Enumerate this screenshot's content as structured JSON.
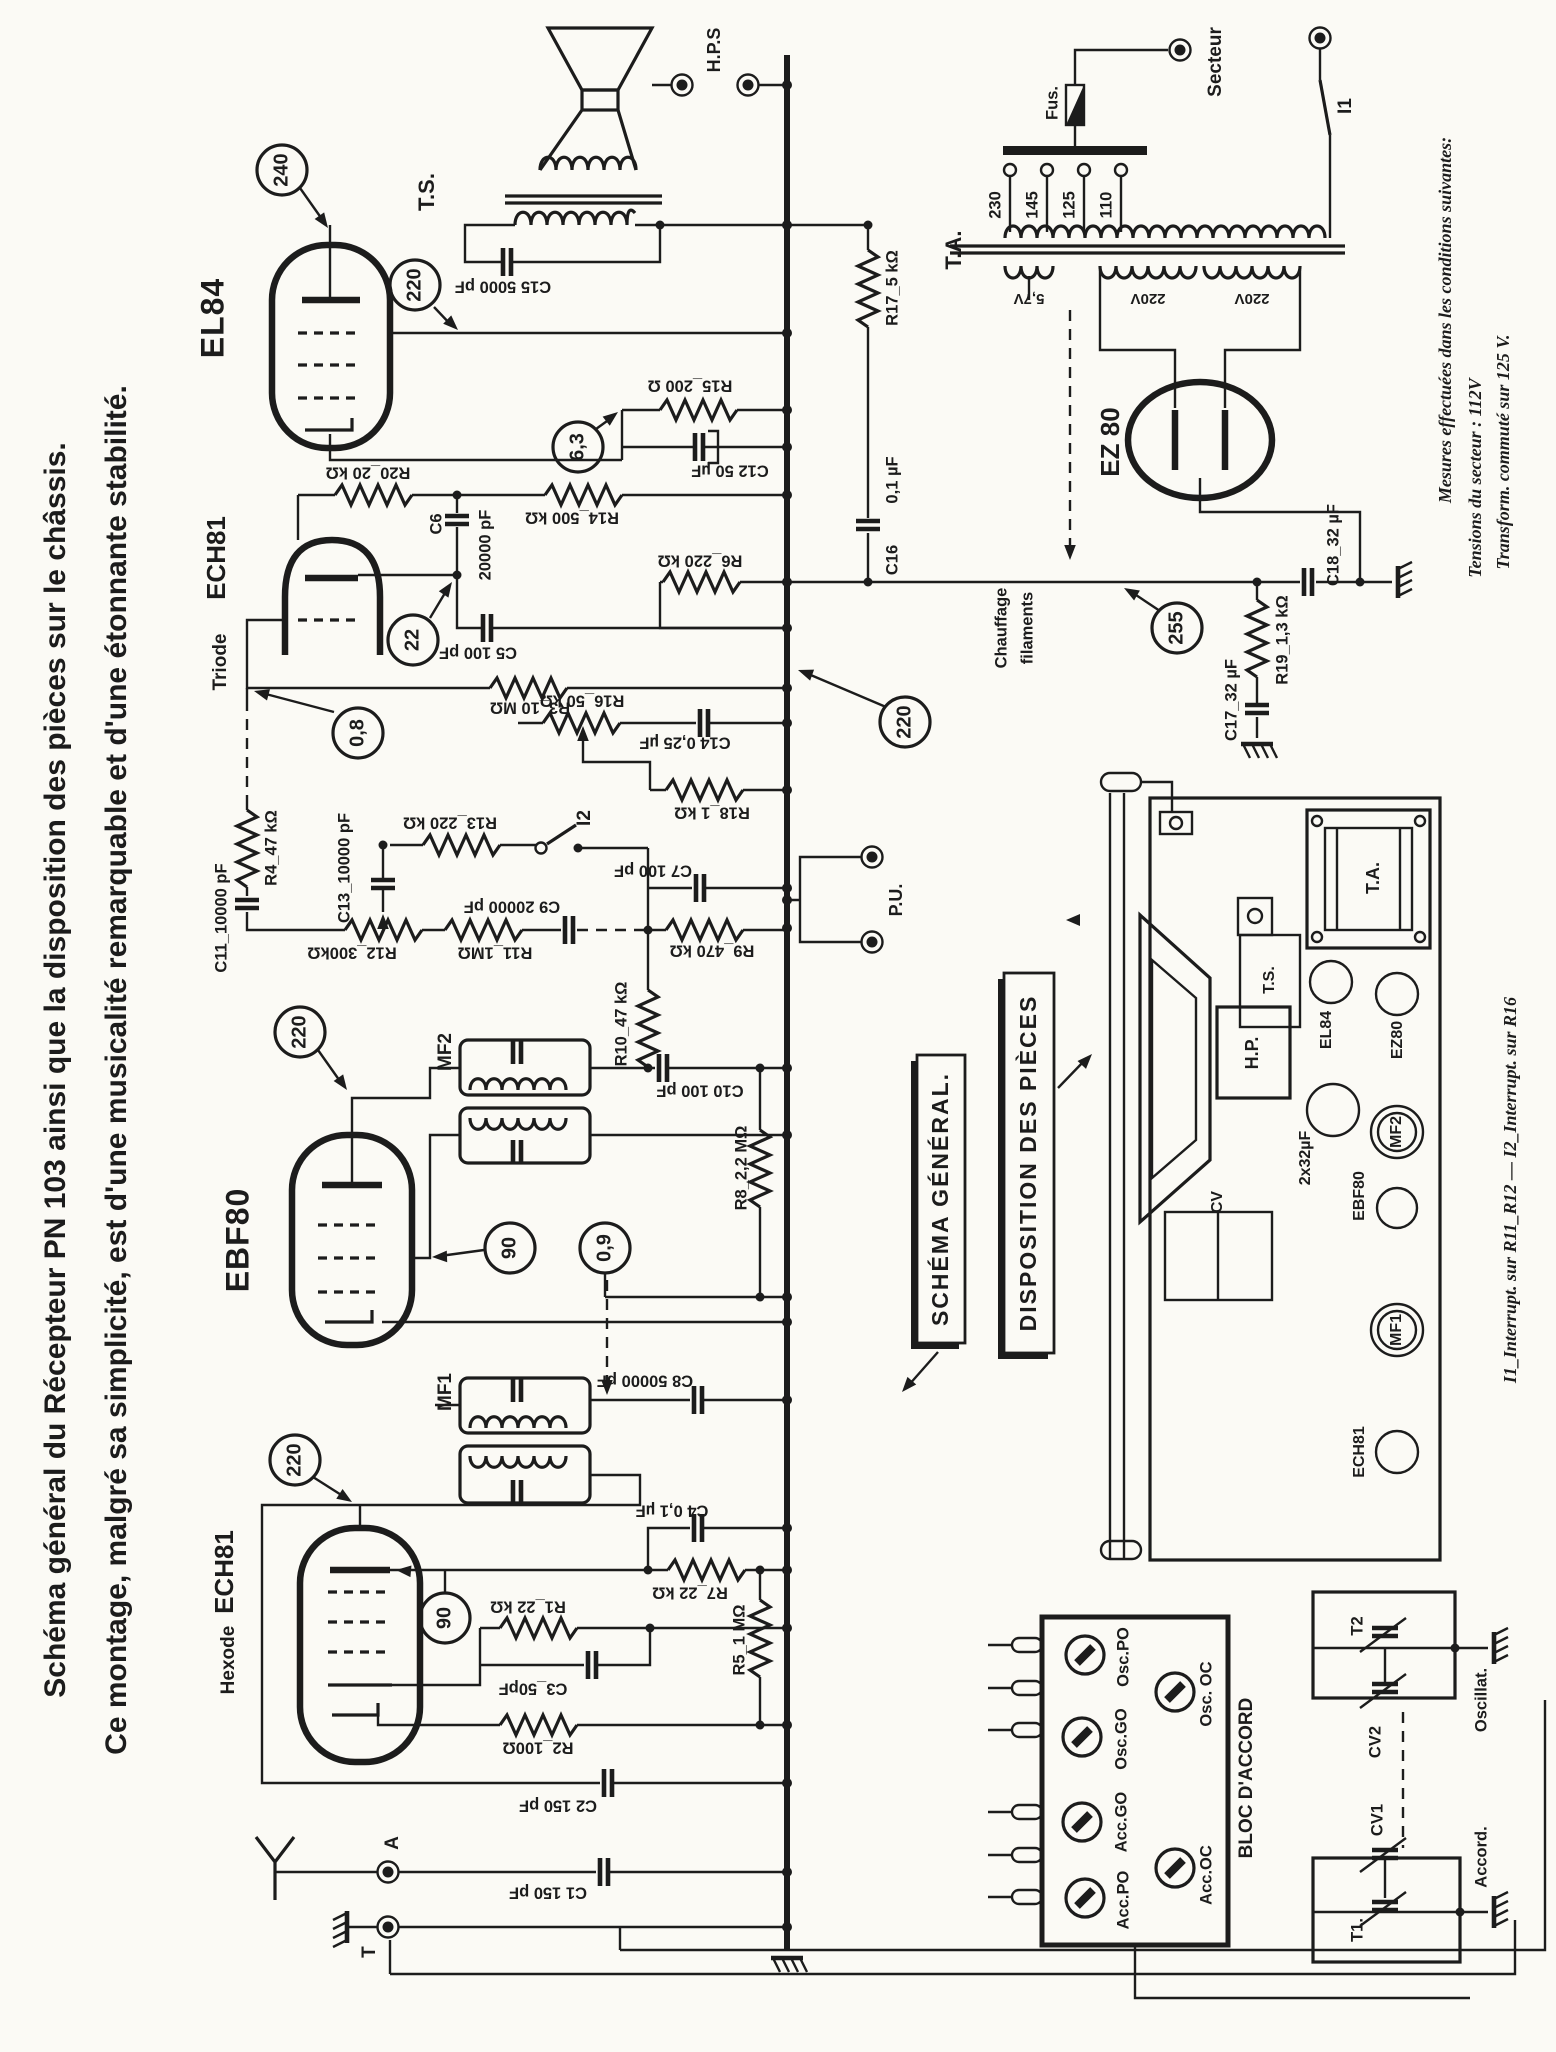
{
  "page": {
    "title_line1": "Schéma général du Récepteur PN 103 ainsi que la disposition des pièces sur le châssis.",
    "title_line2": "Ce montage, malgré sa simplicité, est d'une musicalité remarquable et d'une étonnante stabilité.",
    "paper_color": "#fbfaf5",
    "ink_color": "#1c1c1c"
  },
  "tubes": {
    "el84": "EL84",
    "ech81_triode": "ECH81",
    "triode": "Triode",
    "ebf80": "EBF80",
    "ech81_hexode": "ECH81",
    "hexode": "Hexode",
    "ez80": "EZ 80"
  },
  "transformers": {
    "ts": "T.S.",
    "ta": "T.A.",
    "mf1": "MF1",
    "mf2": "MF2"
  },
  "terminals": {
    "hps": "H.P.S",
    "pu": "P.U.",
    "antenna": "A",
    "earth": "T",
    "secteur": "Secteur"
  },
  "power": {
    "fuse": "Fus.",
    "switch_i1": "I1",
    "taps": {
      "t230": "230",
      "t145": "145",
      "t125": "125",
      "t110": "110"
    },
    "windings": {
      "heater": "5,7V",
      "hv1": "220V",
      "hv2": "220V"
    },
    "heater_note1": "Chauffage",
    "heater_note2": "filaments"
  },
  "switches": {
    "i2": "I2"
  },
  "resistors": {
    "r1": "R1_22 kΩ",
    "r2": "R2_100Ω",
    "r3": "R3_10 MΩ",
    "r4": "R4_47 kΩ",
    "r5": "R5_1 MΩ",
    "r6": "R6_220 kΩ",
    "r7": "R7_22 kΩ",
    "r8": "R8_2,2 MΩ",
    "r9": "R9_470 kΩ",
    "r10": "R10_47 kΩ",
    "r11": "R11_1MΩ",
    "r12": "R12_300kΩ",
    "r13": "R13_220 kΩ",
    "r14": "R14_500 kΩ",
    "r15": "R15_200 Ω",
    "r16": "R16_50 kΩ",
    "r17": "R17_5 kΩ",
    "r18": "R18_1 kΩ",
    "r19": "R19_1,3 kΩ",
    "r20": "R20_20 kΩ"
  },
  "capacitors": {
    "c1": "C1 150 pF",
    "c2": "C2 150 pF",
    "c3": "C3_50pF",
    "c4": "C4 0,1 µF",
    "c5": "C5 100 pF",
    "c6": "C6",
    "c6_value": "20000 pF",
    "c7": "C7 100 pF",
    "c8": "C8 50000 pF",
    "c9": "C9 20000 pF",
    "c10": "C10 100 pF",
    "c11": "C11_10000 pF",
    "c12": "C12 50 µF",
    "c13": "C13_10000 pF",
    "c14": "C14 0,25 µF",
    "c15": "C15 5000 pF",
    "c16": "C16",
    "c16_value": "0,1 µF",
    "c17": "C17_32 µF",
    "c18": "C18_32 µF"
  },
  "measurements": {
    "el84_anode": "240",
    "el84_screen": "220",
    "heater": "6,3",
    "triode_anode": "22",
    "triode_grid": "0,8",
    "detector": "220",
    "ebf80_anode": "220",
    "ebf80_screen": "90",
    "ebf80_grid": "0,9",
    "hexode_anode": "220",
    "hexode_screen": "90",
    "ht": "255"
  },
  "notes": {
    "mesures_1": "Mesures effectuées dans les conditions suivantes:",
    "mesures_2": "Tensions du secteur : 112V",
    "mesures_3": "Transform. commuté sur 125 V.",
    "interrupteurs": "I1_Interrupt. sur R11_R12 — I2_Interrupt. sur R16"
  },
  "callouts": {
    "schema_general": "SCHÉMA GÉNÉRAL.",
    "disposition": "DISPOSITION DES PIÈCES"
  },
  "bloc_accord": {
    "title": "BLOC  D'ACCORD",
    "knob_osc_po": "Osc.PO",
    "knob_osc_go": "Osc.GO",
    "knob_acc_go": "Acc.GO",
    "knob_acc_po": "Acc.PO",
    "knob_osc_oc": "Osc. OC",
    "knob_acc_oc": "Acc.OC",
    "t1": "T1.",
    "t2": "T2",
    "cv1": "CV1",
    "cv2": "CV2",
    "accord": "Accord.",
    "oscillat": "Oscillat."
  },
  "chassis_layout": {
    "ta": "T.A.",
    "ts": "T.S.",
    "hp": "H.P.",
    "el84": "EL84",
    "ez80": "EZ80",
    "mf2": "MF2",
    "mf1": "MF1",
    "ebf80": "EBF80",
    "ech81": "ECH81",
    "cv": "CV",
    "capacitor": "2x32µF"
  }
}
